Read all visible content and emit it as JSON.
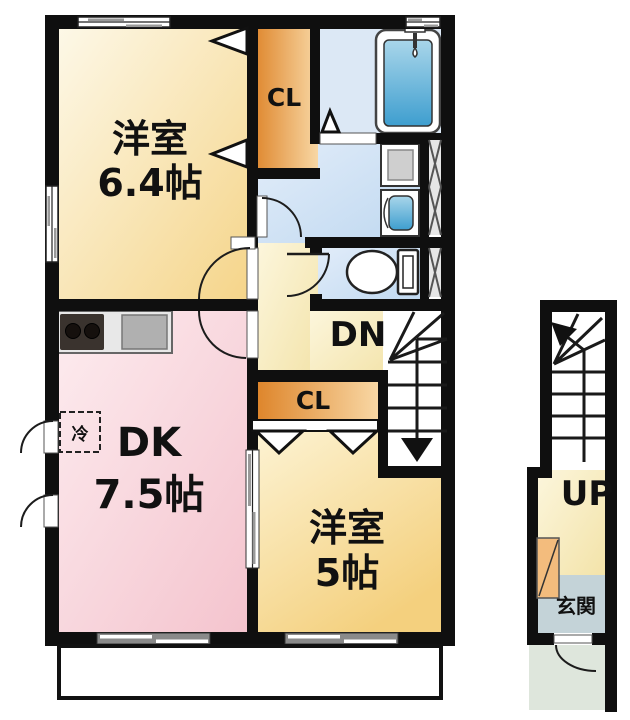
{
  "rooms": {
    "western_room_1": {
      "name": "洋室",
      "size": "6.4帖"
    },
    "dining_kitchen": {
      "name": "DK",
      "size": "7.5帖"
    },
    "western_room_2": {
      "name": "洋室",
      "size": "5帖"
    },
    "closet_upper": {
      "label": "CL"
    },
    "closet_lower": {
      "label": "CL"
    },
    "entrance": {
      "label": "玄関"
    }
  },
  "stairs": {
    "down_label": "DN",
    "up_label": "UP"
  },
  "appliances": {
    "refrigerator_label": "冷"
  },
  "colors": {
    "wall": "#0f0f0f",
    "room64_light": "#fdf9ea",
    "room64_dark": "#f5d488",
    "dk_light": "#fdedf0",
    "dk_dark": "#f4c3cd",
    "room5_light": "#fdf5d8",
    "room5_dark": "#f4d07e",
    "closet_dark": "#dd8226",
    "closet_light": "#f8d7a4",
    "hall_light": "#fcf6dc",
    "hall_dark": "#f3e3a9",
    "wet_light": "#e4eefa",
    "wet_dark": "#bfd8f0",
    "bathroom": "#dce8f5",
    "tub_light": "#a9d6ea",
    "tub_dark": "#3e9ecf",
    "genkan_floor": "#c4d3d8",
    "porch": "#dee6dc",
    "shoe_cabinet": "#f3bc7d",
    "shaft": "#e6e6e6",
    "balcony": "#ffffff"
  }
}
